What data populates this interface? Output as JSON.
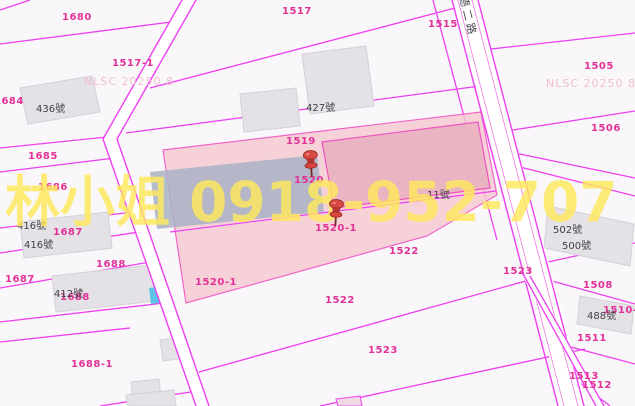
{
  "map": {
    "title": "cadastral-parcel-map",
    "watermark": {
      "contact": "林小姐 0918-952-707",
      "source_label": "NLSC 20250 8"
    },
    "road_name": "德二路",
    "selected_parcels": [
      "1520",
      "1520-1"
    ],
    "colors": {
      "boundary": "#ee3ff0",
      "parcel_label": "#e23297",
      "building_text": "#3f3f46",
      "selection_fill": "#f5c8cf",
      "selection_building": "#eab4c2",
      "building_fill": "#e5e2e7",
      "building_blue": "#a9b3c6",
      "water_cyan": "#5ec4e4",
      "watermark_yellow": "#ffe95c",
      "watermark_pink": "#f0bed0",
      "pin_red": "#c6403a"
    },
    "nlsc_marks": [
      {
        "text": "NLSC 20250 8",
        "x": 84,
        "y": 75
      },
      {
        "text": "NLSC 20250 8",
        "x": 546,
        "y": 77
      }
    ],
    "parcel_labels": [
      {
        "text": "1680",
        "x": 62,
        "y": 12
      },
      {
        "text": "1517",
        "x": 282,
        "y": 6
      },
      {
        "text": "1517-1",
        "x": 112,
        "y": 58
      },
      {
        "text": "1684",
        "x": -6,
        "y": 96
      },
      {
        "text": "1685",
        "x": 28,
        "y": 151
      },
      {
        "text": "1686",
        "x": 38,
        "y": 182
      },
      {
        "text": "1687",
        "x": 53,
        "y": 227
      },
      {
        "text": "1688",
        "x": 96,
        "y": 259
      },
      {
        "text": "1688",
        "x": 60,
        "y": 292
      },
      {
        "text": "1687",
        "x": 5,
        "y": 274
      },
      {
        "text": "1688-1",
        "x": 71,
        "y": 359
      },
      {
        "text": "1519",
        "x": 286,
        "y": 136
      },
      {
        "text": "1520",
        "x": 294,
        "y": 175
      },
      {
        "text": "1520-1",
        "x": 315,
        "y": 223
      },
      {
        "text": "1520-1",
        "x": 195,
        "y": 277
      },
      {
        "text": "1522",
        "x": 389,
        "y": 246
      },
      {
        "text": "1522",
        "x": 325,
        "y": 295
      },
      {
        "text": "1523",
        "x": 368,
        "y": 345
      },
      {
        "text": "1523",
        "x": 503,
        "y": 266
      },
      {
        "text": "1515",
        "x": 428,
        "y": 19
      },
      {
        "text": "1505",
        "x": 584,
        "y": 61
      },
      {
        "text": "1506",
        "x": 591,
        "y": 123
      },
      {
        "text": "1508",
        "x": 583,
        "y": 280
      },
      {
        "text": "1510-4",
        "x": 603,
        "y": 305
      },
      {
        "text": "1511",
        "x": 577,
        "y": 333
      },
      {
        "text": "1513",
        "x": 569,
        "y": 371
      },
      {
        "text": "1512",
        "x": 582,
        "y": 380
      }
    ],
    "building_labels": [
      {
        "text": "436號",
        "x": 36,
        "y": 100
      },
      {
        "text": "427號",
        "x": 306,
        "y": 99
      },
      {
        "text": "416號",
        "x": 17,
        "y": 217
      },
      {
        "text": "416號",
        "x": 24,
        "y": 236
      },
      {
        "text": "412號",
        "x": 54,
        "y": 285
      },
      {
        "text": "11號",
        "x": 427,
        "y": 186
      },
      {
        "text": "502號",
        "x": 553,
        "y": 221
      },
      {
        "text": "500號",
        "x": 562,
        "y": 237
      },
      {
        "text": "488號",
        "x": 587,
        "y": 307
      }
    ]
  }
}
